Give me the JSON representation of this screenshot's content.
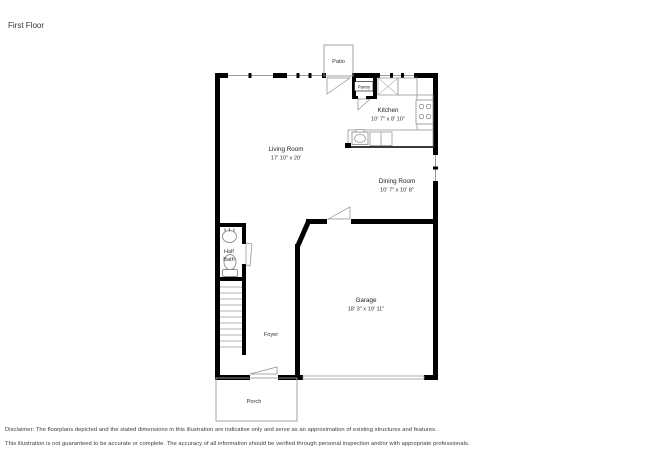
{
  "title": "First Floor",
  "rooms": {
    "living_room": {
      "name": "Living Room",
      "dims": "17' 10\" x 20'"
    },
    "kitchen": {
      "name": "Kitchen",
      "dims": "10' 7\" x 8' 10\""
    },
    "dining_room": {
      "name": "Dining Room",
      "dims": "10' 7\" x 10' 8\""
    },
    "garage": {
      "name": "Garage",
      "dims": "18' 3\" x 19' 11\""
    },
    "half_bath": {
      "line1": "Half",
      "line2": "Bath"
    },
    "foyer": {
      "name": "Foyer"
    },
    "pantry": {
      "name": "Pantry"
    },
    "patio": {
      "name": "Patio"
    },
    "porch": {
      "name": "Porch"
    }
  },
  "disclaimer": {
    "line1": "Disclaimer: The floorplans depicted and the stated dimensions in this illustration are indicative only and serve as an approximation of existing structures and features.",
    "line2": "This illustration is not guaranteed to be accurate or complete. The accuracy of all information should be verified through personal inspection and/or with appropriate professionals."
  },
  "colors": {
    "wall": "#000000",
    "fixture_line": "#8c8c8c",
    "light_line": "#9a9a9a",
    "text": "#222222"
  }
}
